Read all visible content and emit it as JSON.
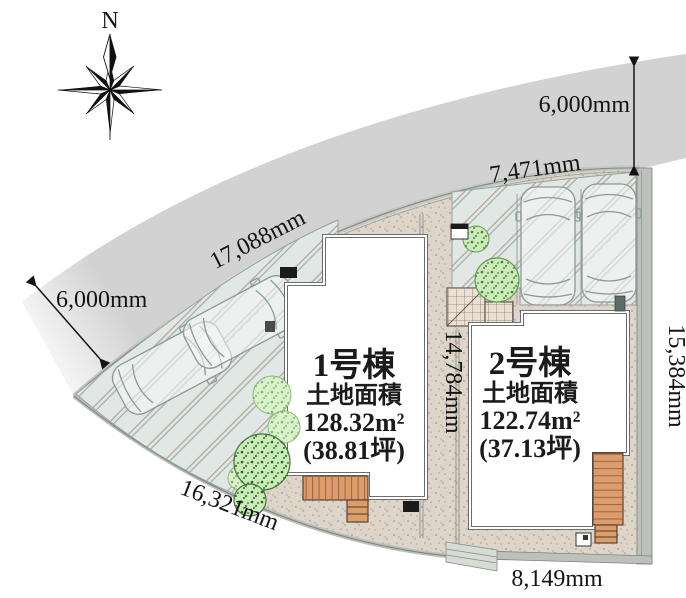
{
  "compass": {
    "north_label": "N"
  },
  "dimensions": {
    "road_width_right": "6,000mm",
    "frontage_upper_right": "7,471mm",
    "frontage_road_left": "17,088mm",
    "road_width_left": "6,000mm",
    "center_boundary": "14,784mm",
    "east_boundary": "15,384mm",
    "southwest_boundary": "16,321mm",
    "south_boundary": "8,149mm"
  },
  "buildings": [
    {
      "name": "1号棟",
      "area_title": "土地面積",
      "area_sqm": "128.32m²",
      "area_tsubo": "(38.81坪)"
    },
    {
      "name": "2号棟",
      "area_title": "土地面積",
      "area_sqm": "122.74m²",
      "area_tsubo": "(37.13坪)"
    }
  ],
  "colors": {
    "road": "#d2d2d2",
    "plot": "#ddd5ca",
    "parking_pad": "#e0e7e4",
    "deck": "#dd9c6c",
    "tree_light": "#d8f2c9",
    "tree_dark": "#c9ecb8",
    "text": "#141414"
  }
}
